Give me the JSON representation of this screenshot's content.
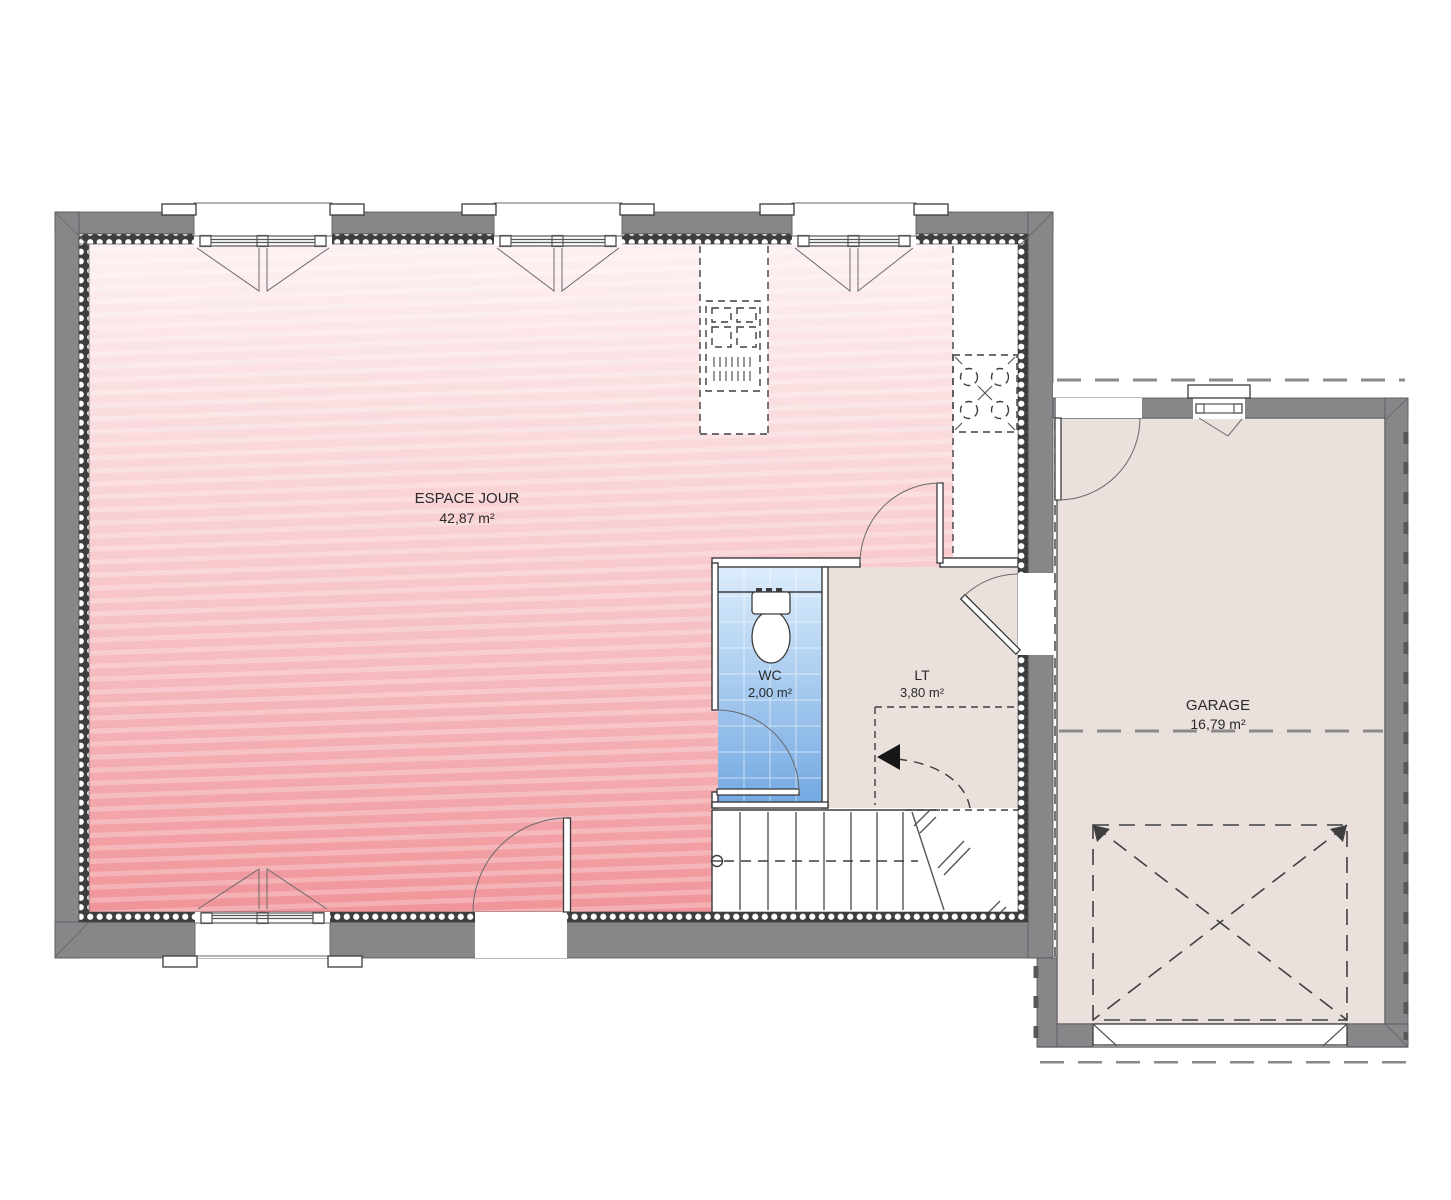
{
  "plan": {
    "title": "Rez-de-chaussée",
    "rooms": [
      {
        "id": "espace-jour",
        "name": "ESPACE JOUR",
        "area": "42,87 m²"
      },
      {
        "id": "wc",
        "name": "WC",
        "area": "2,00 m²"
      },
      {
        "id": "lt",
        "name": "LT",
        "area": "3,80 m²"
      },
      {
        "id": "garage",
        "name": "GARAGE",
        "area": "16,79 m²"
      }
    ],
    "colors": {
      "wall_gray": "#87878a",
      "insulation_dark": "#3e3e40",
      "living_floor_top": "#fdf0f1",
      "living_floor_bottom": "#f0959a",
      "annex_floor": "#eae0dc",
      "wc_floor_top": "#dcedfc",
      "wc_floor_bottom": "#74a9e2",
      "line": "#3c3c3e"
    }
  }
}
